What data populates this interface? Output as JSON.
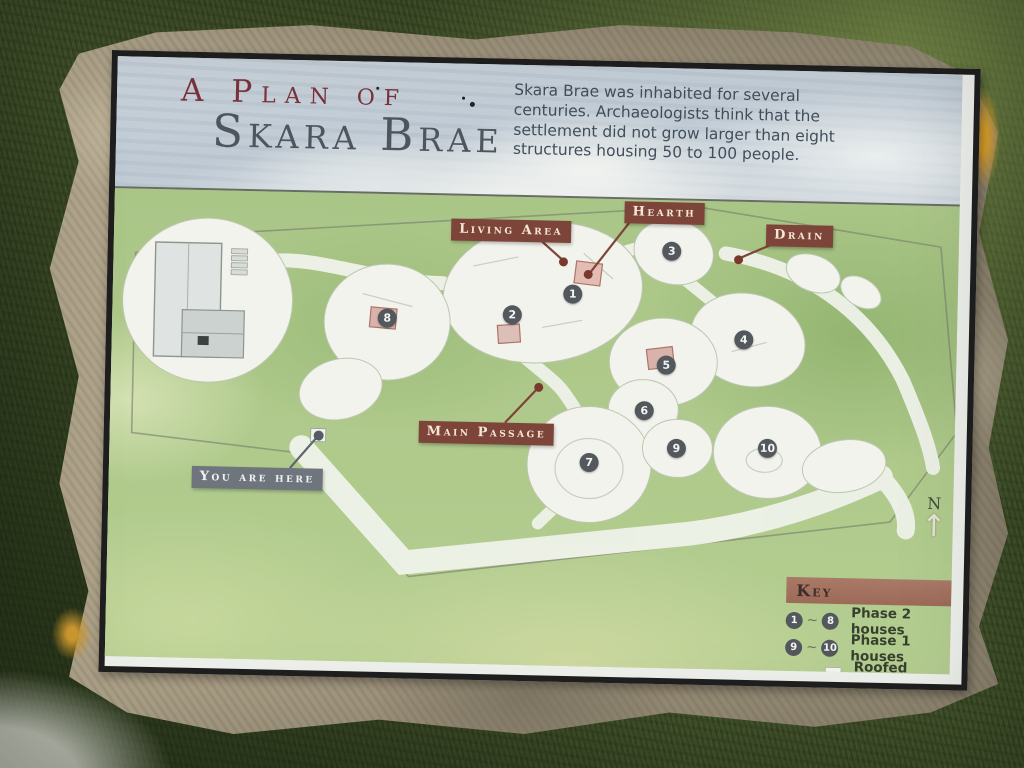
{
  "sign": {
    "title": {
      "prefix": "A Plan of",
      "main": "Skara Brae"
    },
    "intro": "Skara Brae was inhabited for several centuries. Archaeologists think that the settlement did not grow larger than eight structures housing 50 to 100 people.",
    "map": {
      "labels": [
        {
          "id": "living-area",
          "text": "Living Area",
          "x": 337,
          "y": 23
        },
        {
          "id": "hearth",
          "text": "Hearth",
          "x": 510,
          "y": 2
        },
        {
          "id": "drain",
          "text": "Drain",
          "x": 652,
          "y": 22
        },
        {
          "id": "main-passage",
          "text": "Main Passage",
          "x": 309,
          "y": 226
        },
        {
          "id": "you-are-here",
          "text": "You are here",
          "x": 83,
          "y": 276
        }
      ],
      "houses": [
        {
          "number": "1",
          "x": 460,
          "y": 96
        },
        {
          "number": "2",
          "x": 400,
          "y": 118
        },
        {
          "number": "3",
          "x": 558,
          "y": 51
        },
        {
          "number": "4",
          "x": 632,
          "y": 138
        },
        {
          "number": "5",
          "x": 555,
          "y": 165
        },
        {
          "number": "6",
          "x": 534,
          "y": 211
        },
        {
          "number": "7",
          "x": 480,
          "y": 264
        },
        {
          "number": "8",
          "x": 275,
          "y": 124
        },
        {
          "number": "9",
          "x": 567,
          "y": 248
        },
        {
          "number": "10",
          "x": 658,
          "y": 246
        }
      ],
      "compass": "N"
    },
    "key": {
      "title": "Key",
      "tilde": "~",
      "rows": [
        {
          "from": "1",
          "to": "8",
          "label": "Phase 2 houses"
        },
        {
          "from": "9",
          "to": "10",
          "label": "Phase 1 houses"
        }
      ],
      "roofed": "Roofed areas"
    },
    "colors": {
      "label_brown": "#7d4539",
      "here_gray": "#6e757d",
      "key_bar": "#9d6a58",
      "marker_circle": "#53585d",
      "title_red": "#7a323c",
      "title_gray": "#4e555c"
    }
  }
}
